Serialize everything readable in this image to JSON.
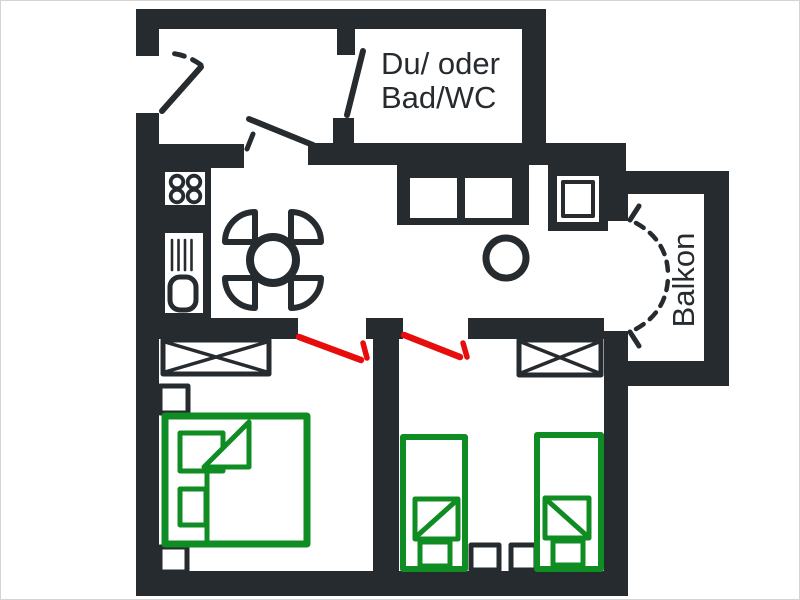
{
  "image": {
    "width": 800,
    "height": 600,
    "background": "#ffffff",
    "frame_border": "#d4d4d4",
    "kind": "apartment floor plan"
  },
  "colors": {
    "wall": "#262b2f",
    "white": "#ffffff",
    "green": "#0f8c22",
    "red": "#e80d0d",
    "text": "#262b2f"
  },
  "labels": {
    "bathroom_line1": "Du/ oder",
    "bathroom_line2": "Bad/WC",
    "balcony": "Balkon"
  },
  "floorplan": {
    "shapes": [
      {
        "t": "rect",
        "name": "wall-top",
        "c": [
          135,
          8,
          410,
          20
        ],
        "f": "wall"
      },
      {
        "t": "rect",
        "name": "wall-left-upper",
        "c": [
          135,
          8,
          23,
          47
        ],
        "f": "wall"
      },
      {
        "t": "rect",
        "name": "wall-left-main",
        "c": [
          135,
          112,
          23,
          483
        ],
        "f": "wall"
      },
      {
        "t": "rect",
        "name": "wall-bottom",
        "c": [
          135,
          570,
          492,
          25
        ],
        "f": "wall"
      },
      {
        "t": "rect",
        "name": "wall-bathroom-right",
        "c": [
          521,
          28,
          24,
          116
        ],
        "f": "wall"
      },
      {
        "t": "rect",
        "name": "wall-hall-kitchen-divider",
        "c": [
          135,
          143,
          108,
          24
        ],
        "f": "wall"
      },
      {
        "t": "rect",
        "name": "wall-living-top",
        "c": [
          307,
          142,
          318,
          22
        ],
        "f": "wall"
      },
      {
        "t": "rect",
        "name": "wall-bathroom-left-stub-top",
        "c": [
          336,
          28,
          18,
          26
        ],
        "f": "wall"
      },
      {
        "t": "rect",
        "name": "wall-bathroom-left-stub-bottom",
        "c": [
          332,
          117,
          21,
          27
        ],
        "f": "wall"
      },
      {
        "t": "rect",
        "name": "wall-balcony-step",
        "c": [
          603,
          142,
          22,
          51
        ],
        "f": "wall"
      },
      {
        "t": "rect",
        "name": "wall-balcony-top",
        "c": [
          603,
          170,
          125,
          23
        ],
        "f": "wall"
      },
      {
        "t": "rect",
        "name": "wall-balcony-right",
        "c": [
          703,
          193,
          25,
          192
        ],
        "f": "wall"
      },
      {
        "t": "rect",
        "name": "wall-balcony-bottom",
        "c": [
          627,
          360,
          101,
          25
        ],
        "f": "wall"
      },
      {
        "t": "rect",
        "name": "wall-living-right-upper",
        "c": [
          603,
          193,
          24,
          27
        ],
        "f": "wall"
      },
      {
        "t": "rect",
        "name": "wall-right-lower",
        "c": [
          603,
          330,
          24,
          265
        ],
        "f": "wall"
      },
      {
        "t": "rect",
        "name": "wall-bedrooms-top-left",
        "c": [
          155,
          317,
          142,
          21
        ],
        "f": "wall"
      },
      {
        "t": "rect",
        "name": "wall-bedrooms-top-stub",
        "c": [
          365,
          317,
          37,
          21
        ],
        "f": "wall"
      },
      {
        "t": "rect",
        "name": "wall-bedrooms-top-right",
        "c": [
          467,
          317,
          136,
          21
        ],
        "f": "wall"
      },
      {
        "t": "rect",
        "name": "wall-bedroom-divider",
        "c": [
          372,
          338,
          26,
          237
        ],
        "f": "wall"
      },
      {
        "t": "rect",
        "name": "kitchen-counter-block",
        "c": [
          157,
          164,
          53,
          154
        ],
        "f": "wall"
      },
      {
        "t": "rect",
        "name": "stove-top",
        "c": [
          164,
          171,
          40,
          33
        ],
        "f": "white"
      },
      {
        "t": "circle",
        "name": "stove-burner-1",
        "c": [
          176,
          181,
          6.3
        ],
        "f": "white",
        "s": "wall",
        "w": 3.8
      },
      {
        "t": "circle",
        "name": "stove-burner-2",
        "c": [
          193,
          181,
          6.3
        ],
        "f": "white",
        "s": "wall",
        "w": 3.8
      },
      {
        "t": "circle",
        "name": "stove-burner-3",
        "c": [
          176,
          195,
          6.3
        ],
        "f": "white",
        "s": "wall",
        "w": 3.8
      },
      {
        "t": "circle",
        "name": "stove-burner-4",
        "c": [
          193,
          195,
          6.3
        ],
        "f": "white",
        "s": "wall",
        "w": 3.8
      },
      {
        "t": "rect",
        "name": "sink-counter",
        "c": [
          164,
          232,
          38,
          80
        ],
        "f": "white"
      },
      {
        "t": "path",
        "name": "sink-drainer-lines",
        "d": "M 171 239 V 269 M 177.5 239 V 269 M 184 239 V 269 M 190.5 239 V 269",
        "s": "wall",
        "w": 2.6
      },
      {
        "t": "rect",
        "name": "sink-basin",
        "c": [
          169,
          276,
          26,
          33
        ],
        "rx": 10,
        "f": "white",
        "s": "wall",
        "w": 5
      },
      {
        "t": "path",
        "name": "dining-chair-ne",
        "d": "M 0 0 L 30 0 A 30 30 0 0 0 0 -30 Z",
        "tr": "translate(290,241)",
        "f": "white",
        "s": "wall",
        "w": 6
      },
      {
        "t": "path",
        "name": "dining-chair-se",
        "d": "M 0 0 L 30 0 A 30 30 0 0 0 0 -30 Z",
        "tr": "translate(290,277) rotate(90)",
        "f": "white",
        "s": "wall",
        "w": 6
      },
      {
        "t": "path",
        "name": "dining-chair-sw",
        "d": "M 0 0 L 30 0 A 30 30 0 0 0 0 -30 Z",
        "tr": "translate(254,277) rotate(180)",
        "f": "white",
        "s": "wall",
        "w": 6
      },
      {
        "t": "path",
        "name": "dining-chair-nw",
        "d": "M 0 0 L 30 0 A 30 30 0 0 0 0 -30 Z",
        "tr": "translate(254,241) rotate(270)",
        "f": "white",
        "s": "wall",
        "w": 6
      },
      {
        "t": "circle",
        "name": "dining-table",
        "c": [
          272,
          259,
          23
        ],
        "f": "white",
        "s": "wall",
        "w": 8
      },
      {
        "t": "rect",
        "name": "sofa-frame",
        "c": [
          396,
          160,
          132,
          64
        ],
        "f": "wall"
      },
      {
        "t": "rect",
        "name": "sofa-cushion-left",
        "c": [
          409,
          177,
          47,
          40
        ],
        "f": "white"
      },
      {
        "t": "rect",
        "name": "sofa-cushion-right",
        "c": [
          464,
          177,
          47,
          40
        ],
        "f": "white"
      },
      {
        "t": "rect",
        "name": "armchair-frame",
        "c": [
          547,
          164,
          60,
          66
        ],
        "f": "wall"
      },
      {
        "t": "rect",
        "name": "armchair-inner",
        "c": [
          556,
          175,
          42,
          46
        ],
        "f": "white"
      },
      {
        "t": "rect",
        "name": "armchair-seat",
        "c": [
          562,
          181,
          30,
          34
        ],
        "f": "white",
        "s": "wall",
        "w": 4
      },
      {
        "t": "circle",
        "name": "side-table",
        "c": [
          505,
          257,
          20
        ],
        "f": "white",
        "s": "wall",
        "w": 7
      },
      {
        "t": "line",
        "name": "entry-door-leaf",
        "c": [
          161,
          110,
          200,
          66
        ],
        "s": "wall",
        "w": 6
      },
      {
        "t": "path",
        "name": "entry-door-swing-arc",
        "d": "M 200 64 A 60 60 0 0 0 167 52",
        "s": "wall",
        "w": 5,
        "dash": "10 9"
      },
      {
        "t": "line",
        "name": "bathroom-door-leaf",
        "c": [
          362,
          50,
          346,
          114
        ],
        "s": "wall",
        "w": 6
      },
      {
        "t": "line",
        "name": "hall-door-leaf",
        "c": [
          312,
          144,
          248,
          118
        ],
        "s": "wall",
        "w": 6
      },
      {
        "t": "line",
        "name": "hall-door-swing-tick",
        "c": [
          246,
          148,
          252,
          133
        ],
        "s": "wall",
        "w": 5
      },
      {
        "t": "line",
        "name": "balcony-door-hinge-top",
        "c": [
          629,
          219,
          638,
          205
        ],
        "s": "wall",
        "w": 5
      },
      {
        "t": "line",
        "name": "balcony-door-hinge-bottom",
        "c": [
          629,
          331,
          638,
          345
        ],
        "s": "wall",
        "w": 5
      },
      {
        "t": "path",
        "name": "balcony-door-arc-top",
        "d": "M 635 222 Q 667 240 667 274",
        "s": "wall",
        "w": 4.5,
        "dash": "9 8"
      },
      {
        "t": "path",
        "name": "balcony-door-arc-bottom",
        "d": "M 635 328 Q 667 310 667 274",
        "s": "wall",
        "w": 4.5,
        "dash": "9 8"
      },
      {
        "t": "rect",
        "name": "wardrobe-1",
        "c": [
          162,
          339,
          106,
          34
        ],
        "f": "white",
        "s": "wall",
        "w": 5
      },
      {
        "t": "path",
        "name": "wardrobe-1-cross",
        "d": "M 164 341 L 266 371 M 164 371 L 266 341",
        "s": "wall",
        "w": 3.5
      },
      {
        "t": "rect",
        "name": "wardrobe-2",
        "c": [
          518,
          339,
          82,
          35
        ],
        "f": "white",
        "s": "wall",
        "w": 5
      },
      {
        "t": "path",
        "name": "wardrobe-2-cross",
        "d": "M 520 341 L 598 372 M 520 372 L 598 341",
        "s": "wall",
        "w": 3.5
      },
      {
        "t": "rect",
        "name": "nightstand-1",
        "c": [
          159,
          385,
          28,
          27
        ],
        "f": "white",
        "s": "wall",
        "w": 5
      },
      {
        "t": "rect",
        "name": "nightstand-2",
        "c": [
          159,
          546,
          27,
          25
        ],
        "f": "white",
        "s": "wall",
        "w": 5
      },
      {
        "t": "rect",
        "name": "nightstand-3",
        "c": [
          470,
          544,
          28,
          25
        ],
        "f": "white",
        "s": "wall",
        "w": 5
      },
      {
        "t": "rect",
        "name": "nightstand-4",
        "c": [
          510,
          544,
          25,
          25
        ],
        "f": "white",
        "s": "wall",
        "w": 5
      },
      {
        "t": "line",
        "name": "bedroom-1-door-leaf",
        "c": [
          298,
          336,
          360,
          359
        ],
        "s": "red",
        "w": 6.5
      },
      {
        "t": "line",
        "name": "bedroom-1-door-tick",
        "c": [
          362,
          342,
          366,
          357
        ],
        "s": "red",
        "w": 5.5
      },
      {
        "t": "line",
        "name": "bedroom-2-door-leaf",
        "c": [
          403,
          334,
          459,
          356
        ],
        "s": "red",
        "w": 6.5
      },
      {
        "t": "line",
        "name": "bedroom-2-door-tick",
        "c": [
          462,
          342,
          466,
          356
        ],
        "s": "red",
        "w": 5.5
      },
      {
        "t": "rect",
        "name": "bed-1-frame",
        "c": [
          164,
          415,
          142,
          128
        ],
        "f": "white",
        "s": "green",
        "w": 7
      },
      {
        "t": "rect",
        "name": "bed-1-pillow-top",
        "c": [
          179,
          432,
          43,
          38
        ],
        "f": "white",
        "s": "green",
        "w": 5
      },
      {
        "t": "rect",
        "name": "bed-1-pillow-bottom",
        "c": [
          179,
          488,
          26,
          36
        ],
        "f": "white",
        "s": "green",
        "w": 5
      },
      {
        "t": "poly",
        "name": "bed-1-blanket-fold",
        "pts": "203,466 248,421 248,466",
        "f": "white",
        "s": "green",
        "w": 5
      },
      {
        "t": "line",
        "name": "bed-1-blanket-edge",
        "c": [
          206,
          466,
          206,
          540
        ],
        "s": "green",
        "w": 5
      },
      {
        "t": "rect",
        "name": "bed-2-frame",
        "c": [
          402,
          436,
          62,
          132
        ],
        "f": "white",
        "s": "green",
        "w": 6
      },
      {
        "t": "rect",
        "name": "bed-2-fold",
        "c": [
          414,
          498,
          43,
          40
        ],
        "f": "white",
        "s": "green",
        "w": 5
      },
      {
        "t": "line",
        "name": "bed-2-fold-diagonal",
        "c": [
          416,
          535,
          455,
          500
        ],
        "s": "green",
        "w": 5
      },
      {
        "t": "rect",
        "name": "bed-2-foot",
        "c": [
          419,
          541,
          30,
          24
        ],
        "f": "white",
        "s": "green",
        "w": 5
      },
      {
        "t": "rect",
        "name": "bed-3-frame",
        "c": [
          536,
          434,
          64,
          134
        ],
        "f": "white",
        "s": "green",
        "w": 6
      },
      {
        "t": "rect",
        "name": "bed-3-fold",
        "c": [
          544,
          497,
          44,
          40
        ],
        "f": "white",
        "s": "green",
        "w": 5
      },
      {
        "t": "line",
        "name": "bed-3-fold-diagonal",
        "c": [
          547,
          500,
          585,
          534
        ],
        "s": "green",
        "w": 5
      },
      {
        "t": "rect",
        "name": "bed-3-foot",
        "c": [
          552,
          540,
          30,
          24
        ],
        "f": "white",
        "s": "green",
        "w": 5
      }
    ]
  }
}
